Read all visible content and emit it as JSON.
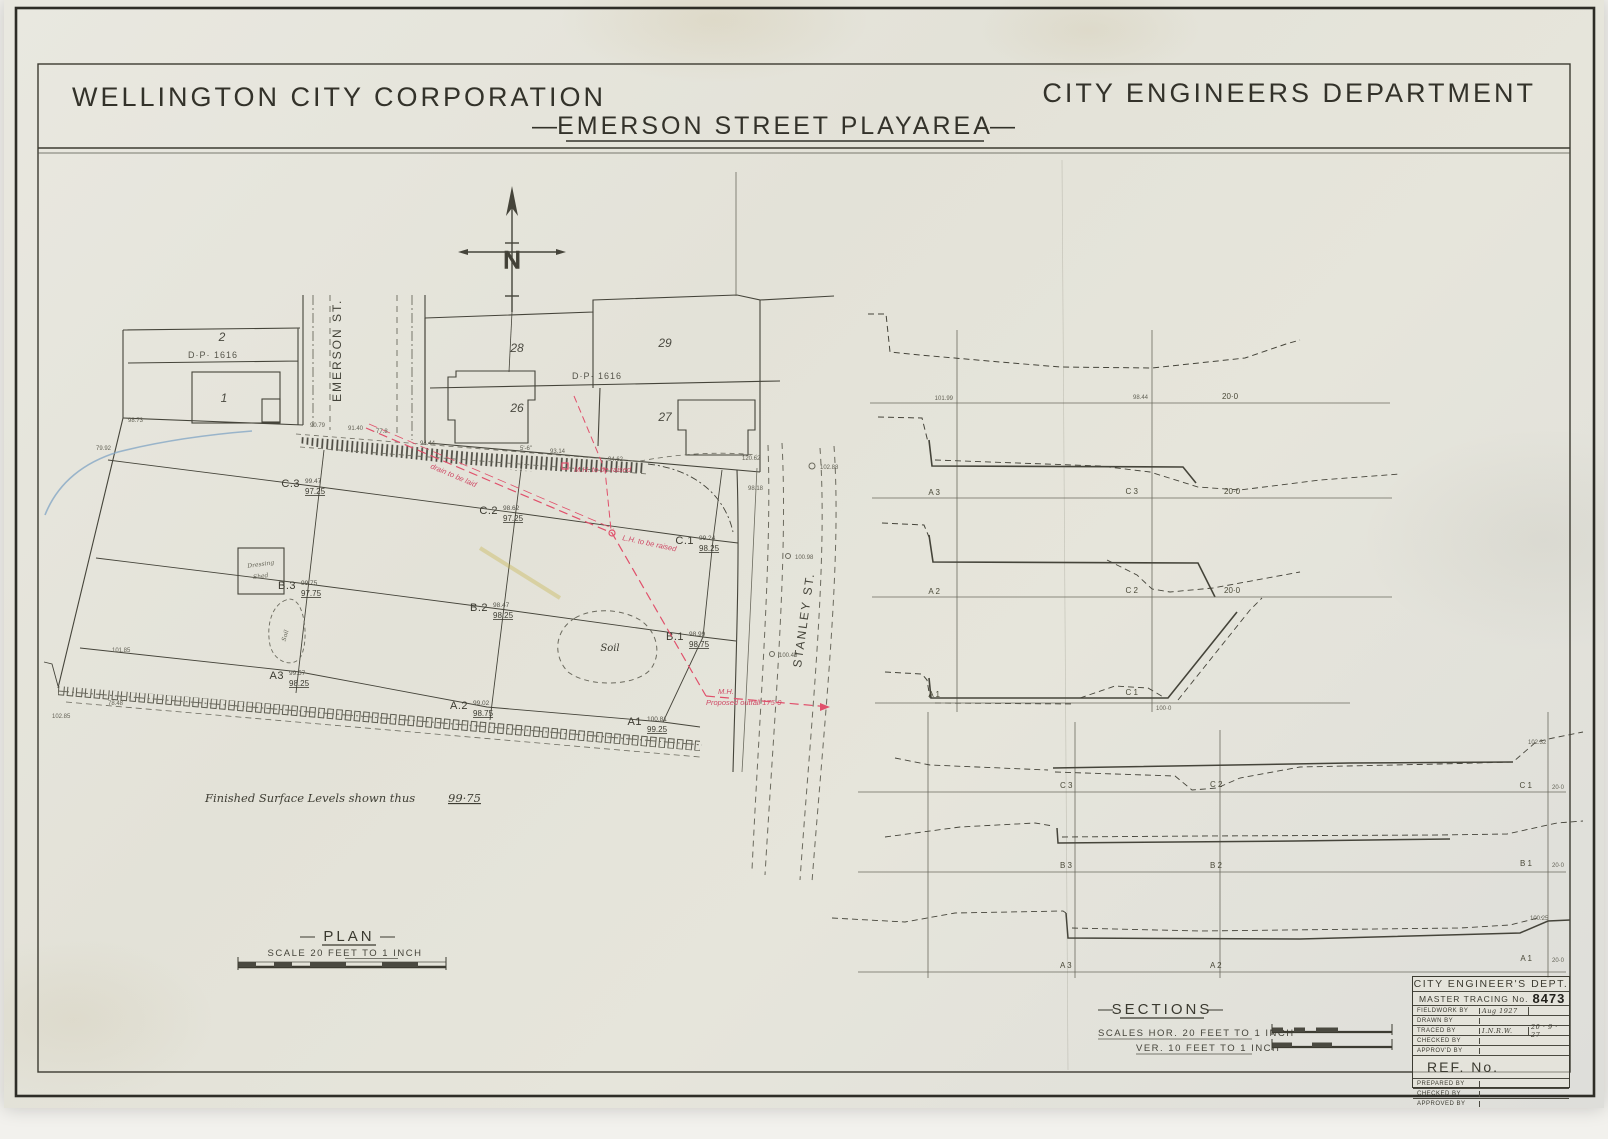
{
  "header": {
    "corp": "WELLINGTON CITY CORPORATION",
    "dept": "CITY ENGINEERS DEPARTMENT",
    "dash": "—",
    "title": "EMERSON STREET PLAYAREA"
  },
  "north_label": "N",
  "plan": {
    "heading": "PLAN",
    "dash": "—",
    "scale_note": "SCALE 20 FEET TO 1 INCH",
    "levels_note_text": "Finished Surface Levels shown thus",
    "levels_note_value": "99·75",
    "streets": {
      "emerson": "EMERSON ST.",
      "stanley": "STANLEY ST."
    },
    "lots": {
      "lot1": "1",
      "lot2": "2",
      "lot26": "26",
      "lot27": "27",
      "lot28": "28",
      "lot29": "29"
    },
    "dp_left": "D·P· 1616",
    "dp_right": "D·P· 1616",
    "dressing_shed_line1": "Dressing",
    "dressing_shed_line2": "Shed",
    "soil_small": "Soil",
    "soil_large": "Soil",
    "grid_points": [
      {
        "id": "C.3",
        "existing": "99.47",
        "finished": "97.25"
      },
      {
        "id": "C.2",
        "existing": "98.62",
        "finished": "97.25"
      },
      {
        "id": "C.1",
        "existing": "99.24",
        "finished": "98.25"
      },
      {
        "id": "B.3",
        "existing": "99.75",
        "finished": "97.75"
      },
      {
        "id": "B.2",
        "existing": "98.47",
        "finished": "98.25"
      },
      {
        "id": "B.1",
        "existing": "98.99",
        "finished": "98.75"
      },
      {
        "id": "A3",
        "existing": "99.57",
        "finished": "98.25"
      },
      {
        "id": "A.2",
        "existing": "99.02",
        "finished": "98.75"
      },
      {
        "id": "A1",
        "existing": "100.81",
        "finished": "99.25"
      }
    ],
    "red_notes": {
      "mh": "M.H. to be raised",
      "lh": "L.H. to be raised",
      "drain": "drain to be laid",
      "outfall_mh": "M.H.",
      "outfall": "Proposed outfall 175·0"
    },
    "spot_levels": [
      "90.79",
      "91.40",
      "77.8",
      "94.44",
      "5'-6\"",
      "93.14",
      "94.62",
      "120.62",
      "102.88",
      "100.98",
      "100.45",
      "101.85",
      "78.48",
      "102.85",
      "98.73",
      "79.92",
      "98.18"
    ]
  },
  "sections": {
    "heading": "SECTIONS",
    "dash": "—",
    "scale_hor": "SCALES  HOR.  20 FEET  TO 1  INCH",
    "scale_ver": "VER.  10 FEET  TO 1  INCH",
    "cross": [
      {
        "v1": "101.99",
        "v2": "98.44",
        "datum": "20·0"
      },
      {
        "left": "A 3",
        "right": "C 3",
        "datum": "20·0"
      },
      {
        "left": "A 2",
        "right": "C 2",
        "datum": "20·0"
      },
      {
        "left": "A 1",
        "right": "C 1",
        "datum": "100·0"
      }
    ],
    "long": [
      {
        "p3": "C 3",
        "p2": "C 2",
        "p1": "C 1",
        "datum": "20·0",
        "peak": "102.32"
      },
      {
        "p3": "B 3",
        "p2": "B 2",
        "p1": "B 1",
        "datum": "20·0",
        "peak": ""
      },
      {
        "p3": "A 3",
        "p2": "A 2",
        "p1": "A 1",
        "datum": "20·0",
        "peak": "100.25"
      }
    ]
  },
  "title_block": {
    "dept": "CITY ENGINEER'S DEPT.",
    "master_tracing_label": "MASTER TRACING No.",
    "master_tracing_no": "8473",
    "rows": [
      {
        "label": "FIELDWORK BY",
        "value": "Aug 1927",
        "value2": ""
      },
      {
        "label": "DRAWN BY",
        "value": "",
        "value2": ""
      },
      {
        "label": "TRACED BY",
        "value": "I.N.R.W.",
        "value2": "20 · 9 · 27"
      },
      {
        "label": "CHECKED BY",
        "value": "",
        "value2": ""
      },
      {
        "label": "APPROV'D BY",
        "value": "",
        "value2": ""
      }
    ],
    "ref_label": "REF. No.",
    "bottom_rows": [
      {
        "label": "PREPARED BY"
      },
      {
        "label": "CHECKED BY"
      },
      {
        "label": "APPROVED BY"
      }
    ]
  }
}
